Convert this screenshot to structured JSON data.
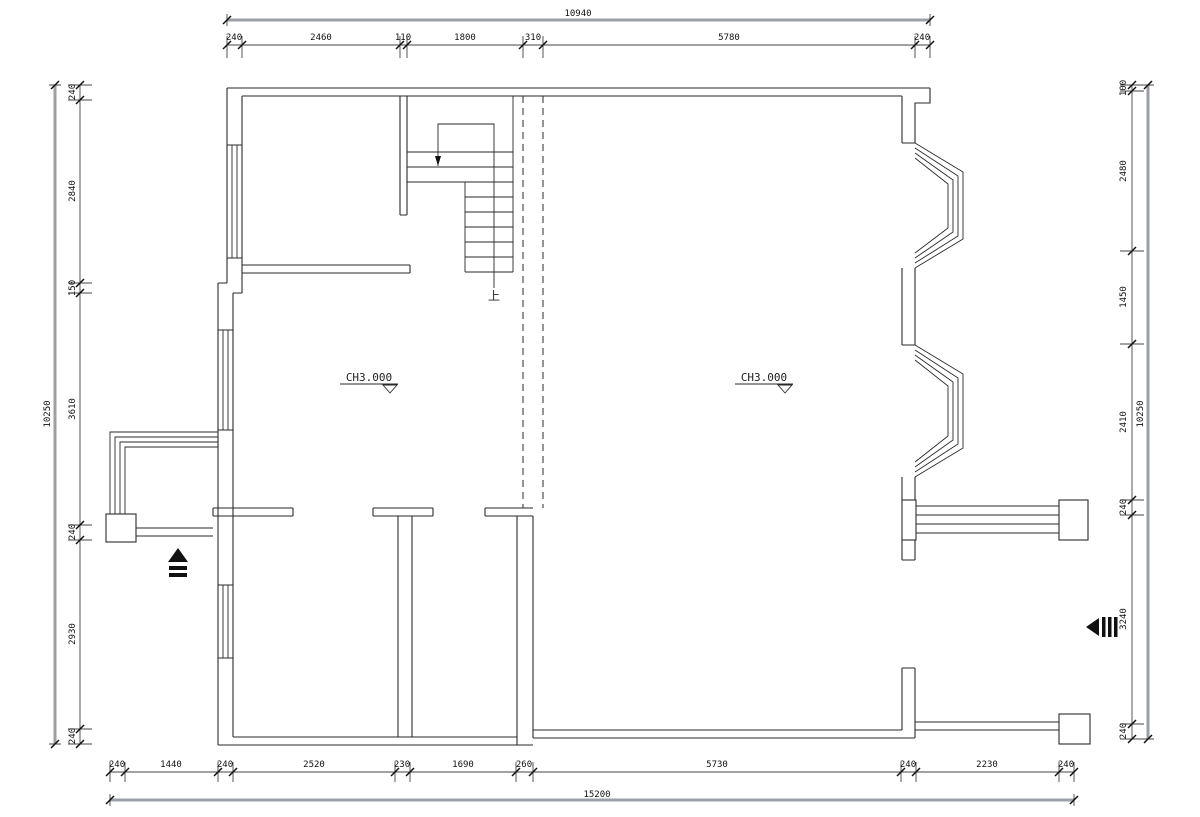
{
  "drawing": {
    "type": "architectural-floor-plan",
    "elevation_label_left": "CH3.000",
    "elevation_label_right": "CH3.000",
    "stairs_up_label": "上"
  },
  "dimensions": {
    "top": {
      "overall": "10940",
      "segments": [
        "240",
        "2460",
        "110",
        "1800",
        "310",
        "5780",
        "240"
      ]
    },
    "bottom": {
      "overall": "15200",
      "segments": [
        "240",
        "1440",
        "240",
        "2520",
        "230",
        "1690",
        "260",
        "5730",
        "240",
        "2230",
        "240"
      ]
    },
    "left": {
      "overall": "10250",
      "segments": [
        "240",
        "2840",
        "150",
        "3610",
        "240",
        "2930",
        "240"
      ]
    },
    "right": {
      "overall": "10250",
      "segments": [
        "100",
        "2480",
        "1450",
        "2410",
        "240",
        "3240",
        "240"
      ]
    }
  },
  "colors": {
    "line": "#2a2a2a",
    "dimension_line": "#444444",
    "overall_dimension_line": "#9aa0a6",
    "background": "#ffffff"
  }
}
